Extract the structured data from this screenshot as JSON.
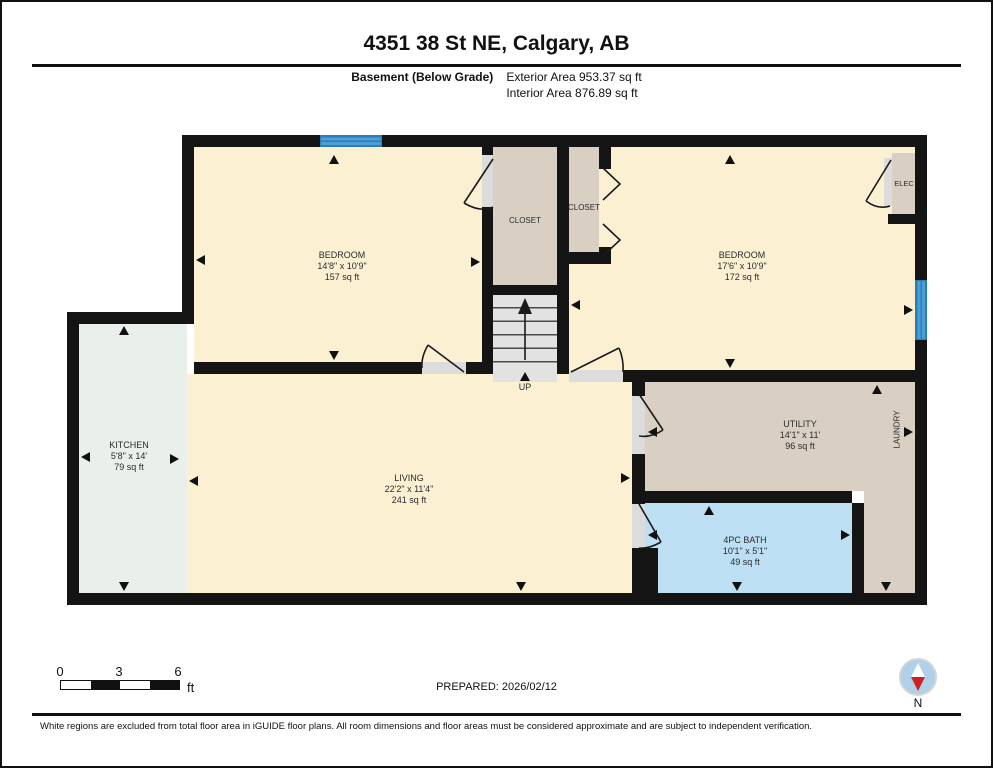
{
  "header": {
    "title": "4351 38 St NE, Calgary, AB",
    "floor_label": "Basement (Below Grade)",
    "exterior_area": "Exterior Area 953.37 sq ft",
    "interior_area": "Interior Area 876.89 sq ft"
  },
  "rooms": {
    "bedroom1": {
      "name": "BEDROOM",
      "dims": "14'8\" x 10'9\"",
      "area": "157 sq ft"
    },
    "bedroom2": {
      "name": "BEDROOM",
      "dims": "17'6\" x 10'9\"",
      "area": "172 sq ft"
    },
    "kitchen": {
      "name": "KITCHEN",
      "dims": "5'8\" x 14'",
      "area": "79 sq ft"
    },
    "living": {
      "name": "LIVING",
      "dims": "22'2\" x 11'4\"",
      "area": "241 sq ft"
    },
    "utility": {
      "name": "UTILITY",
      "dims": "14'1\" x 11'",
      "area": "96 sq ft"
    },
    "bath": {
      "name": "4PC BATH",
      "dims": "10'1\" x 5'1\"",
      "area": "49 sq ft"
    },
    "closet1": {
      "name": "CLOSET"
    },
    "closet2": {
      "name": "CLOSET"
    },
    "elec": {
      "name": "ELEC"
    },
    "laundry": {
      "name": "LAUNDRY"
    },
    "stairs": {
      "label": "UP"
    }
  },
  "footer": {
    "scale": {
      "t0": "0",
      "t3": "3",
      "t6": "6",
      "unit": "ft"
    },
    "prepared": "PREPARED: 2026/02/12",
    "compass": "N",
    "disclaimer": "White regions are excluded from total floor area in iGUIDE floor plans. All room dimensions and floor areas must be considered approximate and are subject to independent verification."
  },
  "colors": {
    "bedroom": "#FBF0D2",
    "closet": "#D9D0C3",
    "kitchen": "#E9F0EC",
    "bath": "#BDDFF4",
    "stairs": "#E2E2E2",
    "window": "#4C9FD5",
    "wall": "#141414",
    "door_gap": "#DCDCDC",
    "compass": "#AFD0E8"
  }
}
